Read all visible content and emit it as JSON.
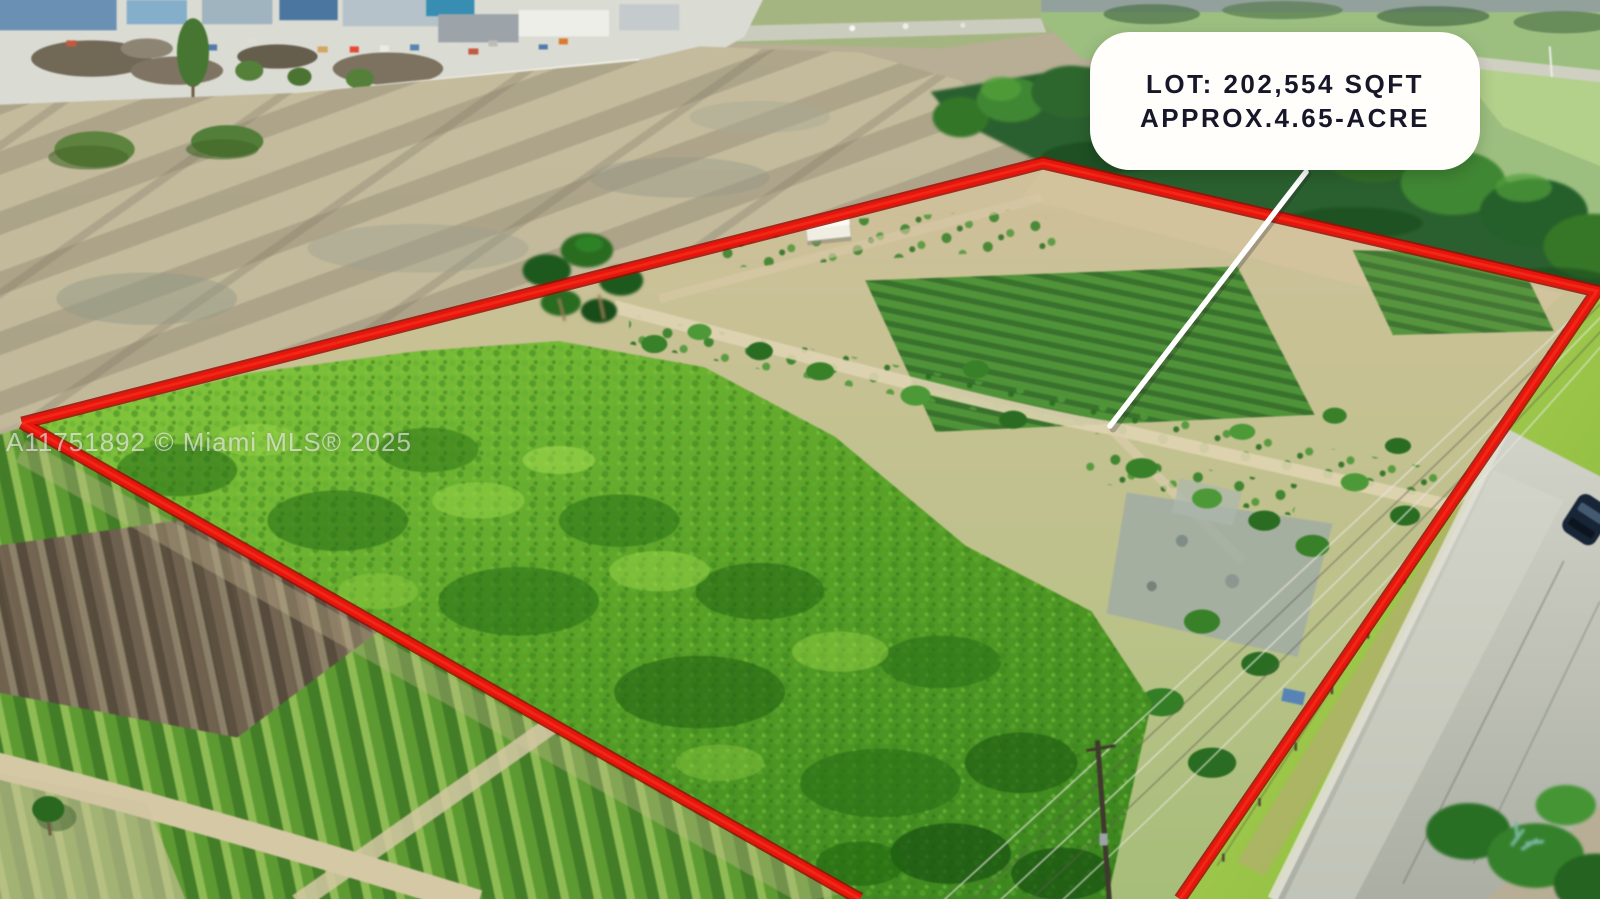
{
  "callout": {
    "line1": "LOT: 202,554 SQFT",
    "line2": "APPROX.4.65-ACRE",
    "background": "#ffffff",
    "text_color": "#17172a"
  },
  "watermark": {
    "text": "A11751892 © Miami MLS® 2025"
  },
  "boundary": {
    "color": "#e8150b"
  },
  "leader": {
    "color": "#ffffff"
  }
}
